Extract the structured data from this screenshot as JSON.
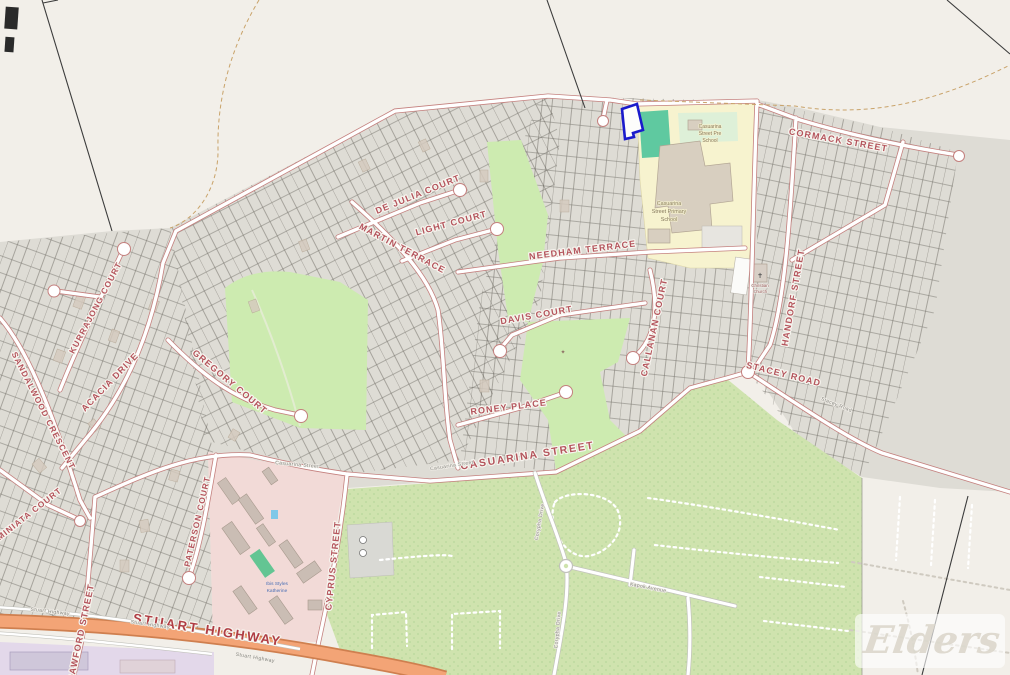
{
  "map": {
    "streets": {
      "cormack": "CORMACK STREET",
      "handorf": "HANDORF STREET",
      "stacey": "STACEY ROAD",
      "needham": "NEEDHAM TERRACE",
      "de_julia": "DE JULIA COURT",
      "martin": "MARTIN TERRACE",
      "light": "LIGHT COURT",
      "davis": "DAVIS COURT",
      "callanan": "CALLANAN COURT",
      "roney": "RONEY PLACE",
      "casuarina": "CASUARINA STREET",
      "gregory": "GREGORY COURT",
      "sandalwood": "SANDALWOOD CRESCENT",
      "kurrajong": "KURRAJONG COURT",
      "acacia": "ACACIA DRIVE",
      "miniata": "MINIATA COURT",
      "paterson": "PATERSON COURT",
      "cyprus": "CYPRUS STREET",
      "crawford": "CRAWFORD STREET",
      "stuart": "STUART HIGHWAY"
    },
    "minor_labels": {
      "stuart_small_1": "Stuart Highway",
      "stuart_small_2": "Stuart Highway",
      "stuart_small_3": "Stuart Highway",
      "casuarina_small_1": "Casuarina Street",
      "casuarina_small_2": "Casuarina Street",
      "corypha_1": "Corypha Drive",
      "corypha_2": "Corypha Drive",
      "kapok": "Kapok Avenue",
      "stacey_small": "Stacey Road"
    },
    "pois": {
      "pre_school_l1": "Casuarina",
      "pre_school_l2": "Street Pre",
      "pre_school_l3": "School",
      "primary_l1": "Casuarina",
      "primary_l2": "Street Primary",
      "primary_l3": "School",
      "church_l1": "Christian",
      "church_l2": "Church",
      "hotel_l1": "Ibis Styles",
      "hotel_l2": "Katherine"
    },
    "watermark": "Elders",
    "colors": {
      "highlight_parcel": "#1a1acc",
      "highway": "#f3a476",
      "park_green": "#cdebb0",
      "school_yellow": "#f7f3cf",
      "commercial_pink": "#f2dad7",
      "street_label": "#b4545c"
    }
  }
}
